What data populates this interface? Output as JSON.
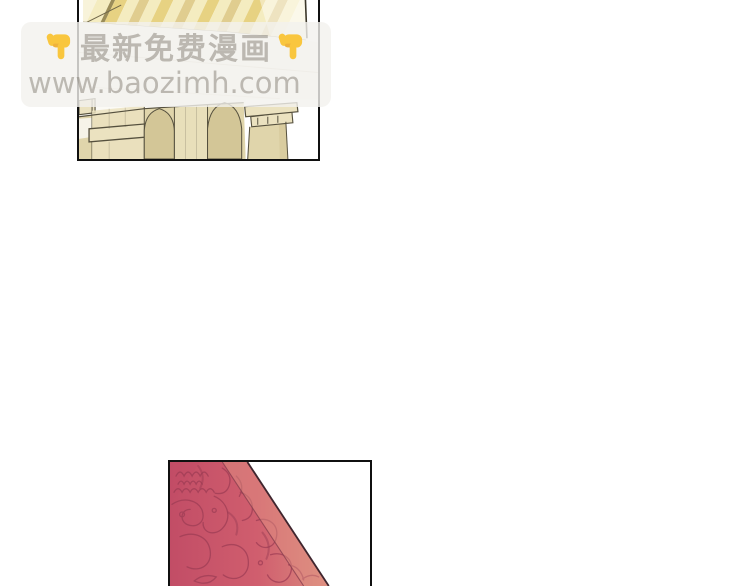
{
  "watermark": {
    "line1": "最新免费漫画",
    "line2": "www.baozimh.com"
  },
  "icons": {
    "hand_left": "pointing-down-hand",
    "hand_right": "pointing-down-hand"
  },
  "colors": {
    "page-bg": "#ffffff",
    "panel-border": "#101010",
    "wm-bg": "rgba(243,241,237,0.8)",
    "wm-text": "rgba(136,130,120,0.52)",
    "hand": "#f9c63e",
    "hand-shade": "#e8a33a",
    "stripe-a": "#e7d282",
    "stripe-b": "#f4ecc0",
    "stripe-c": "#e0cd8f",
    "stripe-dark": "#9a8c58",
    "stripe-pale": "#f8f3da",
    "soffit": "#fbfaf5",
    "beige": "#e0d5ab",
    "beige-light": "#ebe2c0",
    "beige-dark": "#d3c697",
    "ink": "#55503e",
    "fabric-dark": "#c24d66",
    "fabric-base": "#d05e6e",
    "fabric-light": "#db8a7e",
    "fabric-strip": "#e29684",
    "pattern": "#9e3d55",
    "fold": "#8a3f4f",
    "edge": "#3f252e"
  }
}
